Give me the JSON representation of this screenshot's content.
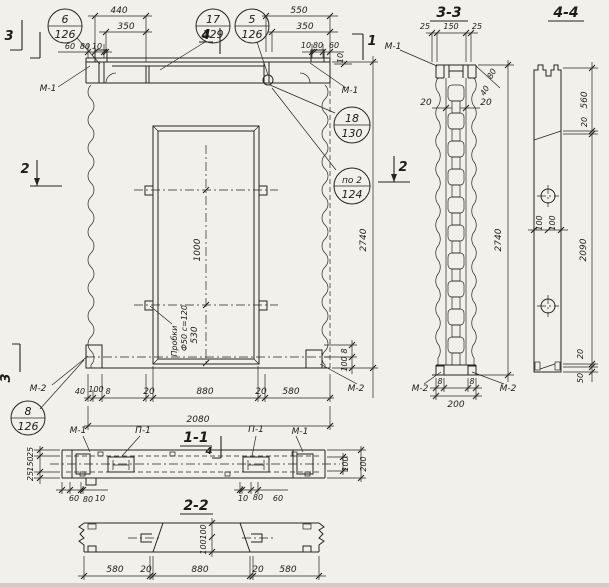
{
  "callouts": {
    "c6": {
      "num": "6",
      "ref": "126"
    },
    "c17": {
      "num": "17",
      "ref": "129"
    },
    "c5": {
      "num": "5",
      "ref": "126"
    },
    "c18": {
      "num": "18",
      "ref": "130"
    },
    "cpo2": {
      "num": "по 2",
      "ref": "124"
    },
    "c8": {
      "num": "8",
      "ref": "126"
    }
  },
  "section_titles": {
    "s11": "1-1",
    "s22": "2-2",
    "s33": "3-3",
    "s44": "4-4"
  },
  "cut_markers": {
    "m1": "1",
    "m2": "2",
    "m3": "3",
    "m4": "4"
  },
  "part_labels": {
    "m1": "М-1",
    "m2": "М-2",
    "p1": "П-1"
  },
  "notes": {
    "plugs1": "Пробки",
    "plugs2": "Ф50 с=120"
  },
  "dims": {
    "d8": "8",
    "d10": "10",
    "d20": "20",
    "d25": "25",
    "d40": "40",
    "d50": "50",
    "d60": "60",
    "d80": "80",
    "d100": "100",
    "d150": "150",
    "d200": "200",
    "d350": "350",
    "d440": "440",
    "d530": "530",
    "d550": "550",
    "d560": "560",
    "d580": "580",
    "d880": "880",
    "d1000": "1000",
    "d2080": "2080",
    "d2090": "2090",
    "d2740": "2740"
  }
}
